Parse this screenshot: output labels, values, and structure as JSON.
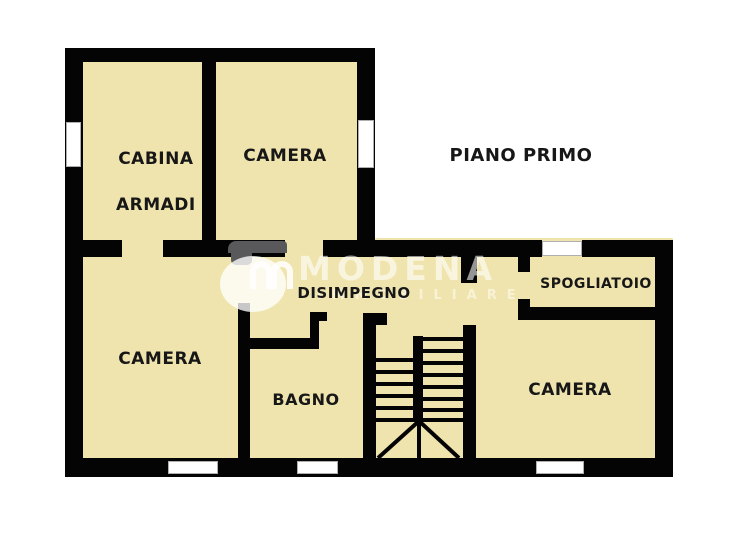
{
  "floor_plan": {
    "title": "PIANO PRIMO",
    "labels": {
      "cabina_armadi_line1": "CABINA",
      "cabina_armadi_line2": "ARMADI",
      "camera_top": "CAMERA",
      "camera_left": "CAMERA",
      "camera_right": "CAMERA",
      "disimpegno": "DISIMPEGNO",
      "bagno": "BAGNO",
      "spogliatoio": "SPOGLIATOIO"
    },
    "watermark": {
      "brand": "MODENA",
      "subtitle": "IMMOBILIARE"
    },
    "colors": {
      "floor": "#f0e4ae",
      "wall": "#040404",
      "label_text": "#171717",
      "watermark_gray": "#59595c",
      "window_border": "#b0aeae",
      "white": "#ffffff"
    }
  }
}
